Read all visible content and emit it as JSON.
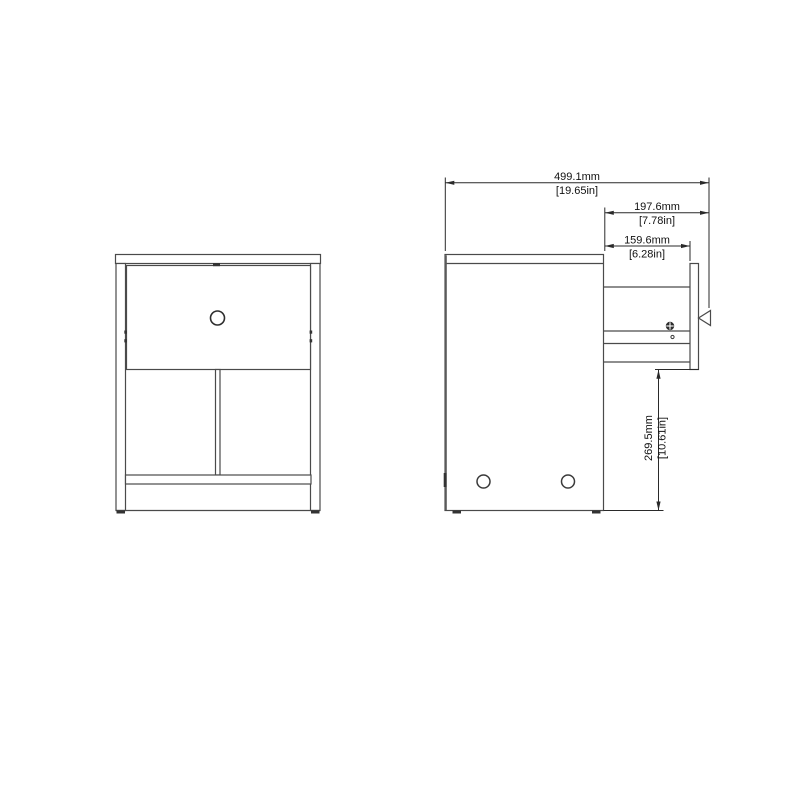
{
  "drawing": {
    "kind": "furniture-two-view-dimension-drawing",
    "views": {
      "front": "front-view",
      "side": "side-view-drawer-open"
    },
    "colors": {
      "background": "#ffffff",
      "geometry_line": "#4a4a4a",
      "dimension_line": "#2a2a2a",
      "text": "#111111"
    },
    "icons": {
      "screw": "screw-head-icon",
      "knob_front": "round-knob",
      "knob_side": "knob-profile"
    }
  },
  "dims": [
    {
      "name": "overall-depth-drawer-open",
      "mm": "499.1mm",
      "in": "[19.65in]"
    },
    {
      "name": "drawer-open-extension",
      "mm": "197.6mm",
      "in": "[7.78in]"
    },
    {
      "name": "drawer-box-extension",
      "mm": "159.6mm",
      "in": "[6.28in]"
    },
    {
      "name": "under-drawer-clearance",
      "mm": "269.5mm",
      "in": "[10.61in]"
    }
  ]
}
